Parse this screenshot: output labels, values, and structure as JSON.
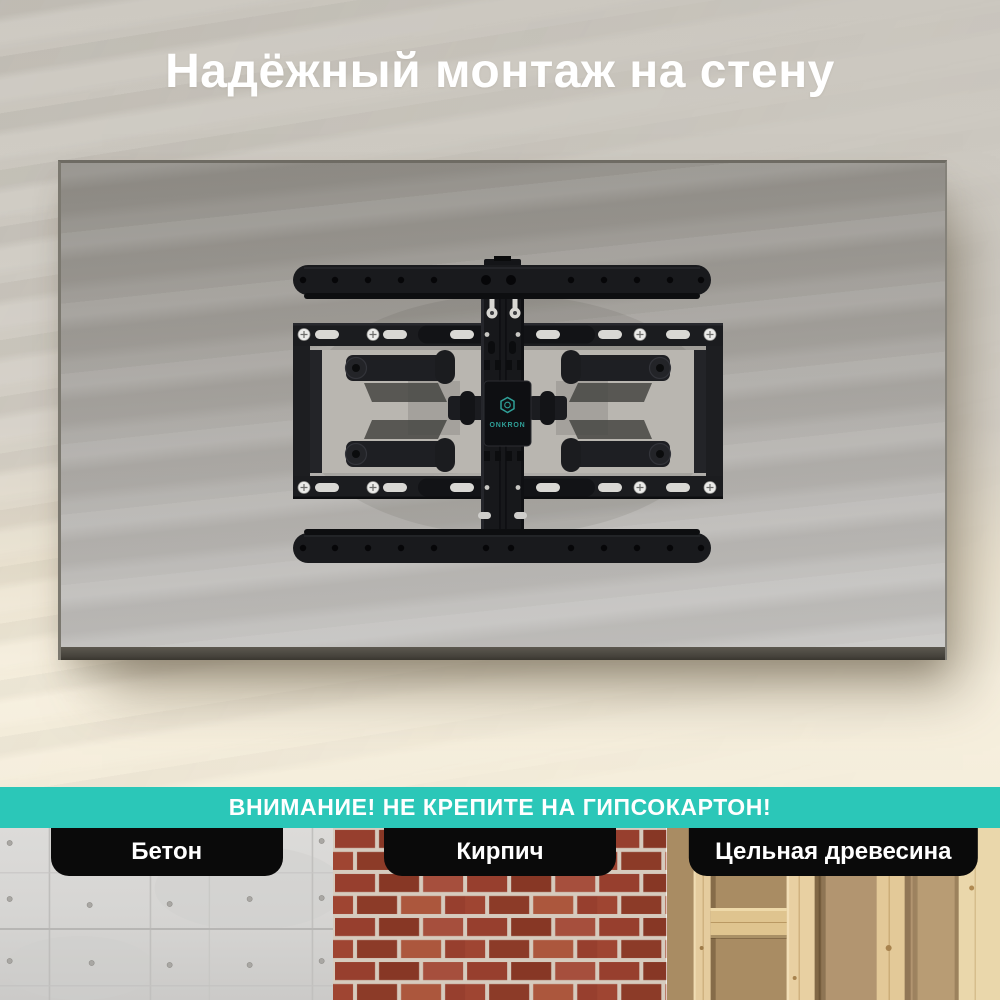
{
  "hero": {
    "title": "Надёжный монтаж на стену",
    "brand_logo": "ONKRON"
  },
  "warning_banner": {
    "text": "ВНИМАНИЕ! НЕ КРЕПИТЕ НА ГИПСОКАРТОН!"
  },
  "materials": {
    "items": [
      {
        "label": "Бетон",
        "texture": "concrete"
      },
      {
        "label": "Кирпич",
        "texture": "brick"
      },
      {
        "label": "Цельная древесина",
        "texture": "wood"
      }
    ]
  },
  "colors": {
    "accent_teal": "#2bc7b8",
    "logo_teal": "#2f9f97",
    "pill_black": "#0a0a0a",
    "wall_beige": "#cfcbc3",
    "wall_cream": "#f5eedc",
    "tv_grey": "#a3a09b",
    "mount_black": "#17181b"
  }
}
